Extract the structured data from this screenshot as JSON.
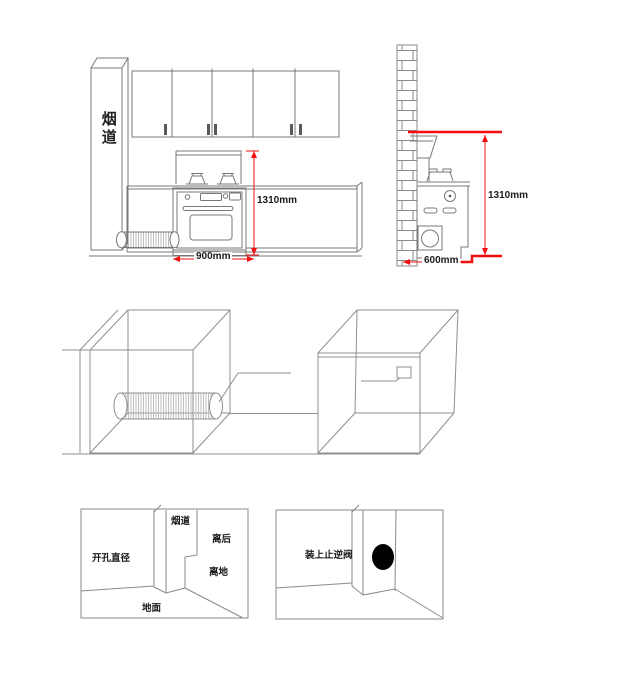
{
  "colors": {
    "line_gray": "#808080",
    "dim_red": "#f20f0f",
    "label_black": "#1a1a1a",
    "hole_black": "#000000"
  },
  "elevation_view": {
    "flue_label": "烟道",
    "height_dimension": "1310mm",
    "width_dimension": "900mm"
  },
  "side_view": {
    "height_dimension": "1310mm",
    "depth_dimension": "600mm"
  },
  "duct_detail_left": {
    "flue_label": "烟道",
    "behind_clearance_label": "离后",
    "hole_diameter_label": "开孔直径",
    "floor_clearance_label": "离地",
    "floor_label": "地面"
  },
  "duct_detail_right": {
    "check_valve_label": "装上止逆阀"
  }
}
